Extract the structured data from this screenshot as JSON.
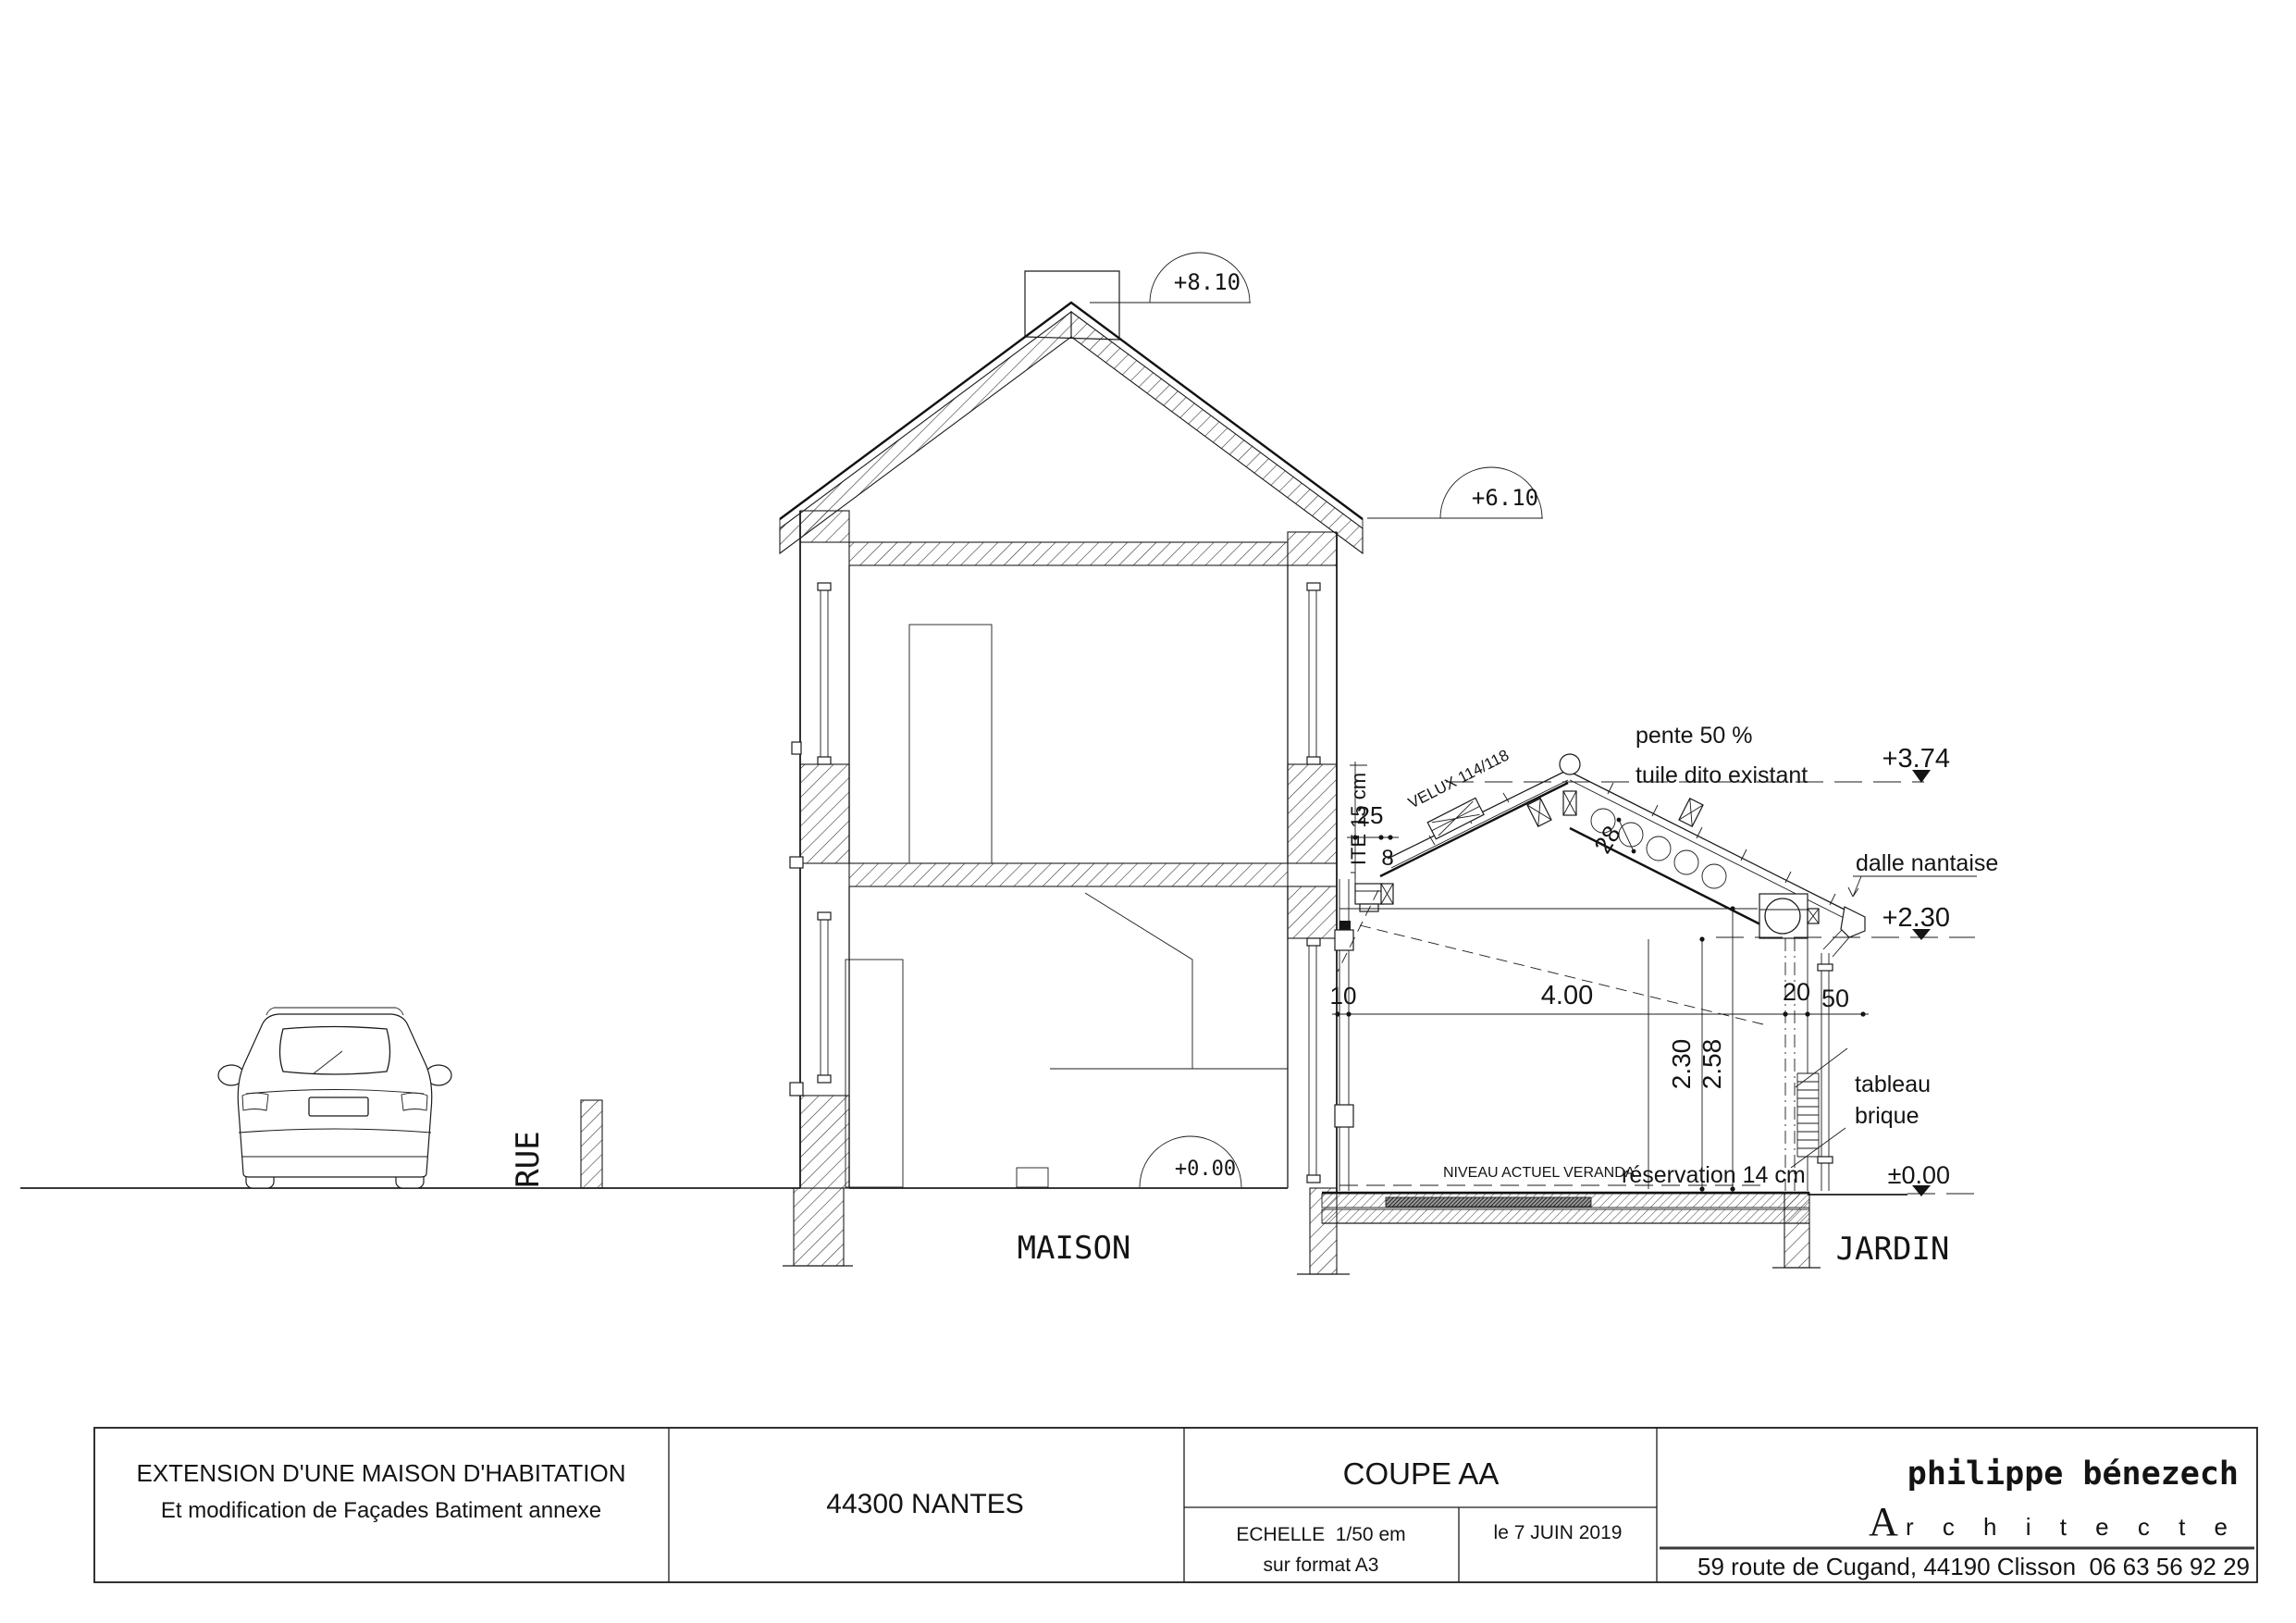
{
  "annotations": {
    "levels": {
      "plus810": "+8.10",
      "plus610": "+6.10",
      "plus374": "+3.74",
      "plus230": "+2.30",
      "plus000": "+0.00",
      "pm000": "±0.00"
    },
    "zones": {
      "rue": "RUE",
      "maison": "MAISON",
      "jardin": "JARDIN"
    },
    "notes": {
      "ite": "ITE 15 cm",
      "velux": "VELUX 114/118",
      "pente": "pente 50 %",
      "tuile": "tuile dito existant",
      "dalle": "dalle nantaise",
      "tableau": "tableau",
      "brique": "brique",
      "niveau": "NIVEAU ACTUEL VERANDA",
      "reservation": "réservation 14 cm"
    },
    "dims": {
      "d25": "25",
      "d8": "8",
      "d28": "28",
      "d10": "10",
      "d400": "4.00",
      "d20": "20",
      "d50": "50",
      "d230": "2.30",
      "d258": "2.58"
    }
  },
  "titleblock": {
    "project_line1": "EXTENSION D'UNE MAISON D'HABITATION",
    "project_line2": "Et modification de Façades Batiment annexe",
    "city": "44300 NANTES",
    "view_title": "COUPE AA",
    "scale_line1": "ECHELLE  1/50 em",
    "scale_line2": "sur format A3",
    "date": "le 7 JUIN 2019",
    "architect_name": "philippe bénezech",
    "architect_initial": "A",
    "architect_rest": "r c h i t e c t e",
    "address": "59 route de Cugand, 44190 Clisson  06 63 56 92 29"
  }
}
